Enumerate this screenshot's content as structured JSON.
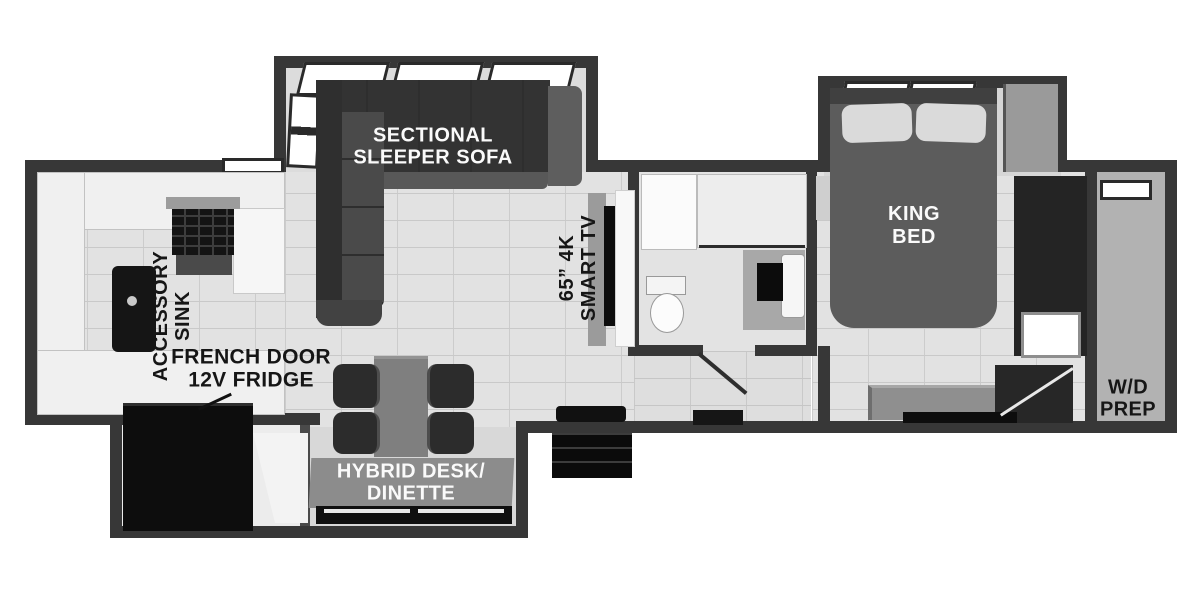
{
  "diagram": {
    "type": "rv-floorplan",
    "style": "grayscale 3d top-down render",
    "colors": {
      "wall": "#373737",
      "floor_tile": "#e2e2e2",
      "grout": "#c9c9c9",
      "dark_furniture": "#2c2c2c",
      "black_fixture": "#111111",
      "sofa": "#3d3d3d",
      "bed": "#5c5c5c",
      "label_plate": "#8c8c8c",
      "closet_floor": "#b2b2b2",
      "label_dark": "#161616",
      "label_light": "#fafafa"
    },
    "labels": {
      "sofa": [
        "SECTIONAL",
        "SLEEPER SOFA"
      ],
      "tv": [
        "65” 4K",
        "SMART TV"
      ],
      "king": [
        "KING",
        "BED"
      ],
      "accessory": [
        "ACCESSORY",
        "SINK"
      ],
      "fridge": [
        "FRENCH DOOR",
        "12V FRIDGE"
      ],
      "dinette": [
        "HYBRID DESK/",
        "DINETTE"
      ],
      "wd": [
        "W/D",
        "PREP"
      ]
    },
    "rooms": [
      {
        "name": "kitchen-front-cap",
        "features": [
          "u-shaped-counter",
          "accessory-sink",
          "cooktop",
          "range-hood",
          "french-door-12v-fridge"
        ]
      },
      {
        "name": "living-area",
        "features": [
          "sectional-sleeper-sofa-slideout",
          "65in-4k-smart-tv",
          "hybrid-desk-dinette-slideout",
          "table-with-four-chairs",
          "entry-door-steps"
        ]
      },
      {
        "name": "bathroom",
        "features": [
          "shower",
          "toilet",
          "vanity-sink",
          "medicine-cabinet",
          "door"
        ]
      },
      {
        "name": "bedroom",
        "features": [
          "king-bed-slideout",
          "wardrobe",
          "dresser",
          "steps"
        ]
      },
      {
        "name": "wd-prep-closet",
        "features": [
          "washer-dryer-prep",
          "window"
        ]
      }
    ]
  }
}
